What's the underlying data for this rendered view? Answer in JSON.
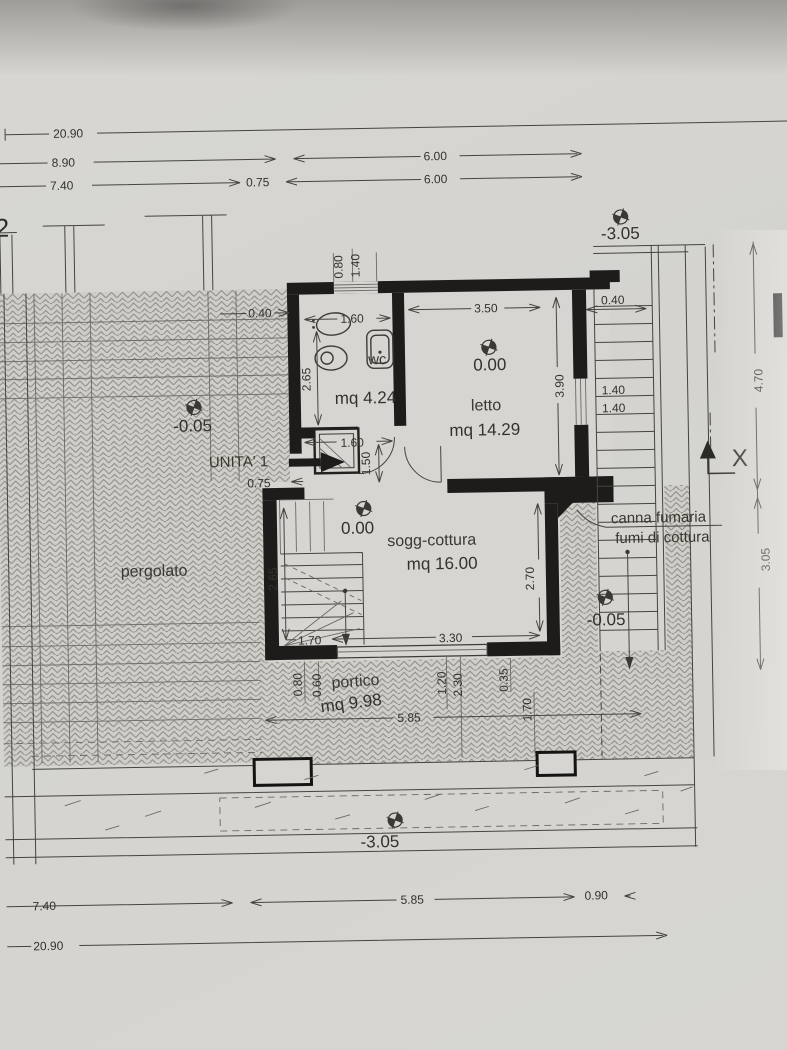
{
  "axis": {
    "grid_label": "2"
  },
  "unit": {
    "label": "UNITA' 1"
  },
  "rooms": [
    {
      "label": "wc",
      "area": "mq 4.24"
    },
    {
      "label": "letto",
      "area": "mq 14.29",
      "level": "0.00"
    },
    {
      "label": "sogg-cottura",
      "area": "mq 16.00",
      "level": "0.00"
    },
    {
      "label": "portico",
      "area": "mq 9.98"
    },
    {
      "label": "pergolato"
    }
  ],
  "notes": {
    "flue_line1": "canna fumaria",
    "flue_line2": "fumi di cottura",
    "section_marker": "X"
  },
  "levels": {
    "top_right": "-3.05",
    "pergolato": "-0.05",
    "court": "-0.05",
    "bottom": "-3.05"
  },
  "dims": {
    "top": [
      "20.90",
      "8.90",
      "7.40",
      "0.75",
      "6.00",
      "6.00"
    ],
    "bottom": [
      "7.40",
      "5.85",
      "0.90",
      "20.90"
    ],
    "right": [
      "4.70",
      "3.05"
    ],
    "left": [
      "0.40"
    ],
    "wc": [
      "0.80",
      "1.40",
      "1.60",
      "2.65",
      "1.60"
    ],
    "letto": [
      "3.50",
      "3.90"
    ],
    "stairs": [
      "0.40",
      "1.40",
      "1.40"
    ],
    "entry": [
      "0.75",
      "1.50"
    ],
    "sogg": [
      "2.65",
      "2.70",
      "1.70",
      "3.30"
    ],
    "portico": [
      "0.80",
      "0.60",
      "1.20",
      "2.30",
      "0.35",
      "1.70",
      "5.85"
    ]
  }
}
